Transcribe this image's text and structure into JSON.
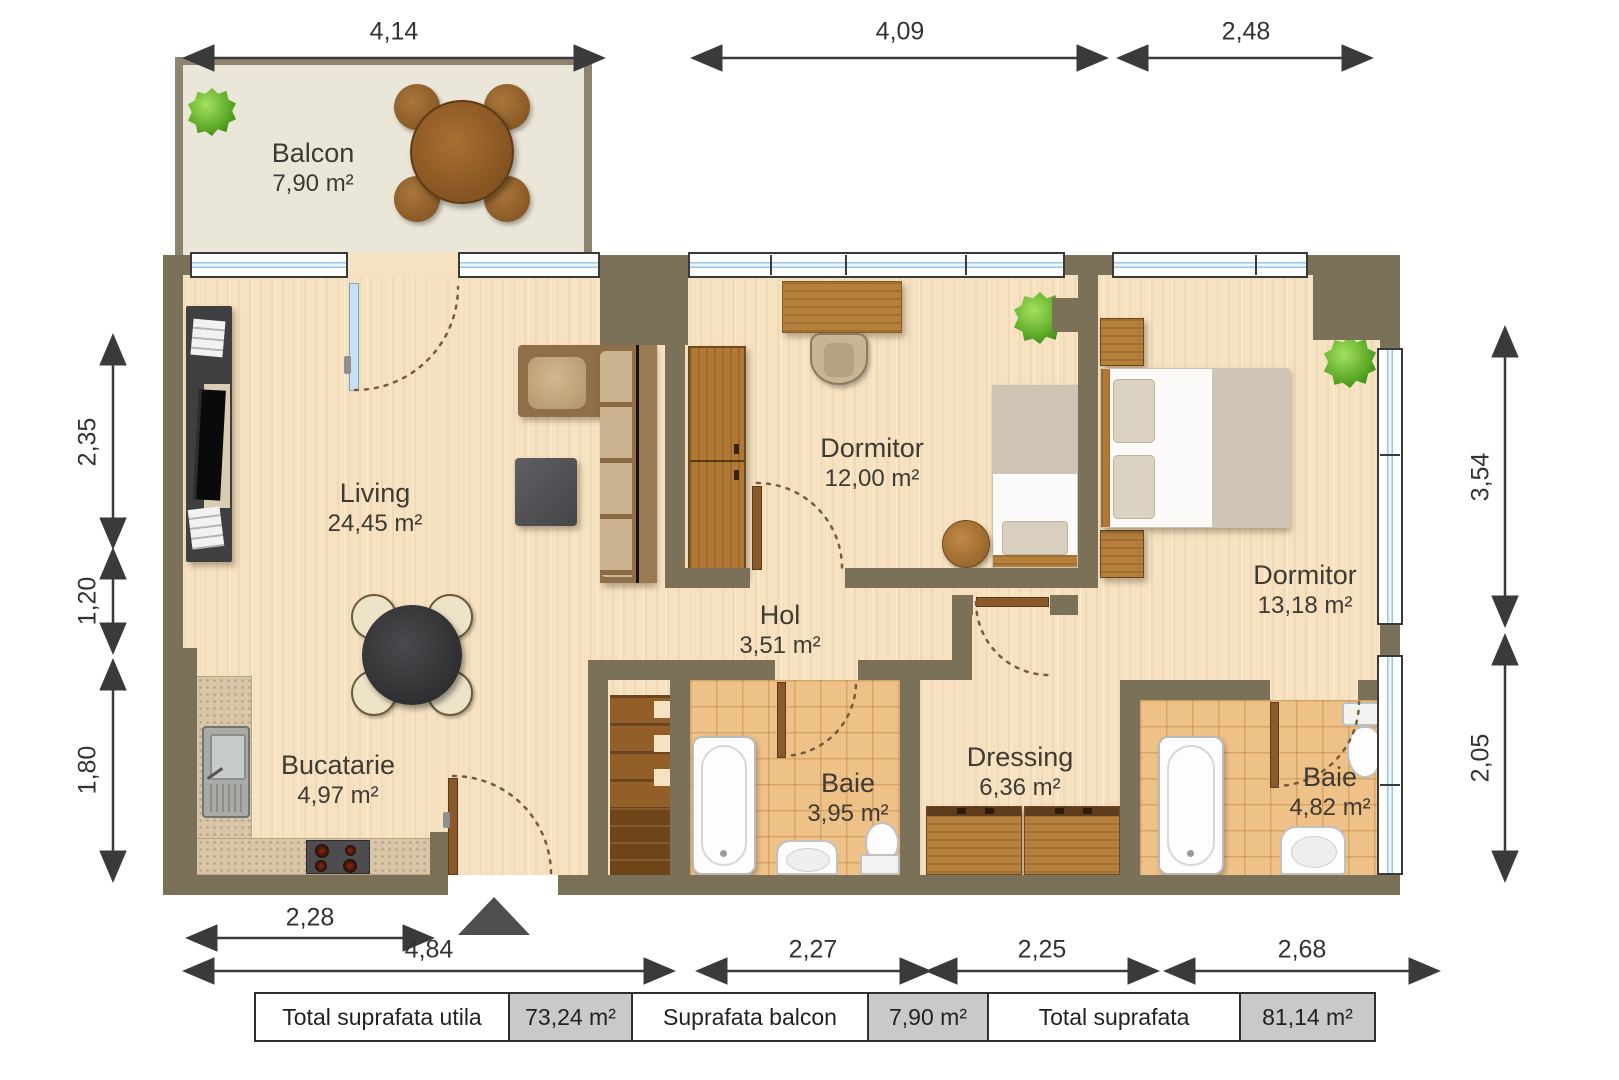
{
  "colors": {
    "wall": "#7b7159",
    "balcony_wall": "#8d8470",
    "floor_wood": "#f6e2c1",
    "floor_tile": "#eec189",
    "floor_balcony": "#eae6d8",
    "window_glass": "#9cc6e4",
    "dimension_line": "#3a3a3a",
    "entry_arrow": "#4e4e4e",
    "table_value_bg": "#c9c9c9"
  },
  "rooms": {
    "balcony": {
      "name": "Balcon",
      "area": "7,90 m²"
    },
    "living": {
      "name": "Living",
      "area": "24,45 m²"
    },
    "kitchen": {
      "name": "Bucatarie",
      "area": "4,97 m²"
    },
    "hall": {
      "name": "Hol",
      "area": "3,51 m²"
    },
    "bedroom1": {
      "name": "Dormitor",
      "area": "12,00 m²"
    },
    "bedroom2": {
      "name": "Dormitor",
      "area": "13,18 m²"
    },
    "bath1": {
      "name": "Baie",
      "area": "3,95 m²"
    },
    "dressing": {
      "name": "Dressing",
      "area": "6,36 m²"
    },
    "bath2": {
      "name": "Baie",
      "area": "4,82 m²"
    }
  },
  "dimensions": {
    "top": [
      "4,14",
      "4,09",
      "2,48"
    ],
    "left": [
      "2,35",
      "1,20",
      "1,80"
    ],
    "right": [
      "3,54",
      "2,05"
    ],
    "bottom_upper": [
      "2,28"
    ],
    "bottom": [
      "4,84",
      "2,27",
      "2,25",
      "2,68"
    ]
  },
  "summary": [
    {
      "label": "Total suprafata utila",
      "value": "73,24 m²"
    },
    {
      "label": "Suprafata balcon",
      "value": "7,90 m²"
    },
    {
      "label": "Total suprafata",
      "value": "81,14 m²"
    }
  ]
}
